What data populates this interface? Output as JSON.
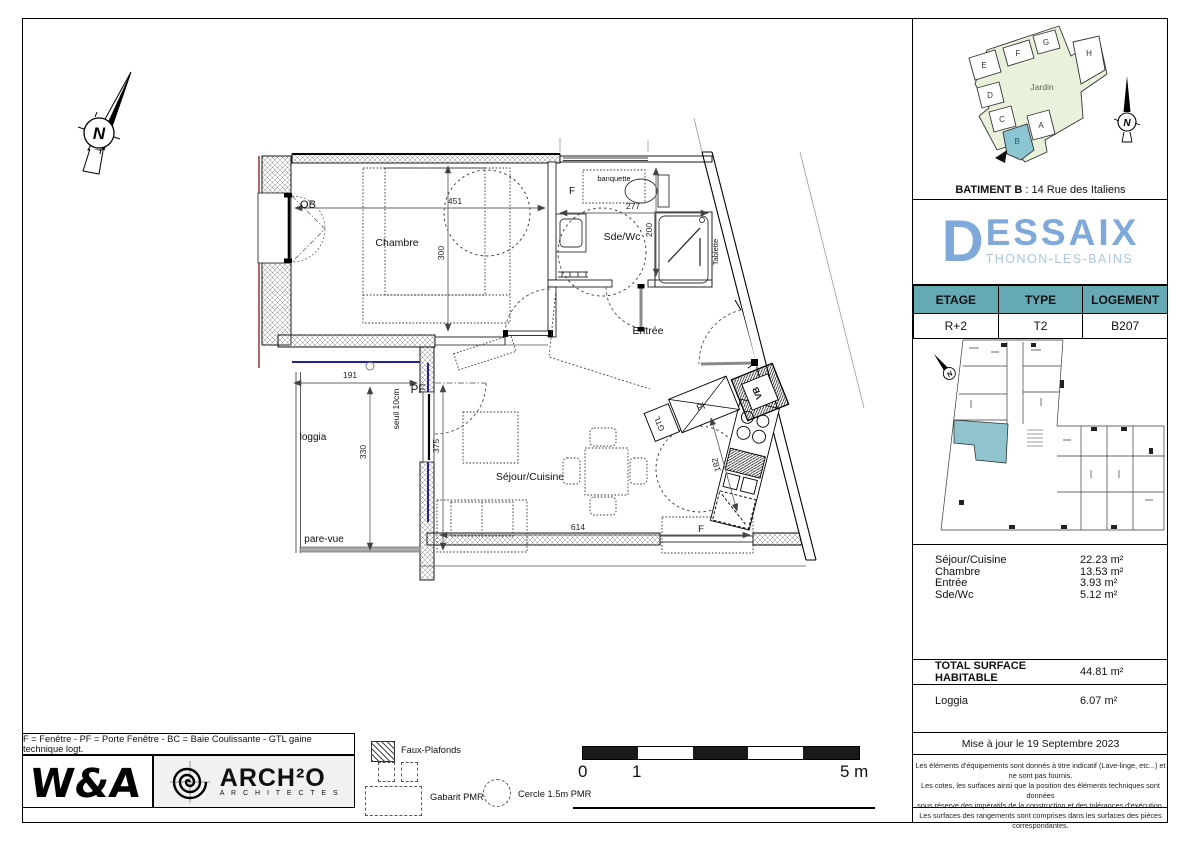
{
  "plan": {
    "north_letter": "N",
    "rooms": {
      "chambre": "Chambre",
      "sdwc": "Sde/Wc",
      "entree": "Entrée",
      "sejour": "Séjour/Cuisine",
      "loggia": "loggia"
    },
    "labels": {
      "ob": "OB",
      "pf": "PF",
      "f_sdb": "F",
      "f_sejour": "F",
      "banquette": "banquette",
      "tablette": "Tablette",
      "seuil": "seuil 10cm",
      "pare_vue": "pare-vue",
      "gtl": "GTL",
      "pl": "Pl",
      "vb": "VB"
    },
    "dims": {
      "chambre_w": "451",
      "chambre_h": "300",
      "sdb_w": "277",
      "sdb_h": "200",
      "loggia_w": "191",
      "loggia_h": "330",
      "sejour_h": "375",
      "sejour_w": "614",
      "cuisine": "182"
    }
  },
  "right_panel": {
    "site_plan": {
      "letters": [
        "A",
        "B",
        "C",
        "D",
        "E",
        "F",
        "G",
        "H"
      ],
      "garden": "Jardin",
      "north_letter": "N",
      "caption_bold": "BATIMENT B",
      "caption_sep": " :  ",
      "caption_text": "14 Rue des Italiens"
    },
    "brand": {
      "initial": "D",
      "rest": "ESSAIX",
      "city": "THONON-LES-BAINS"
    },
    "info": {
      "headers": [
        "ETAGE",
        "TYPE",
        "LOGEMENT"
      ],
      "values": [
        "R+2",
        "T2",
        "B207"
      ]
    },
    "key_plan": {
      "north_letter": "N"
    },
    "surfaces": {
      "rows": [
        {
          "label": "Séjour/Cuisine",
          "value": "22.23 m²"
        },
        {
          "label": "Chambre",
          "value": "13.53 m²"
        },
        {
          "label": "Entrée",
          "value": "3.93 m²"
        },
        {
          "label": "Sde/Wc",
          "value": "5.12 m²"
        }
      ],
      "total_label": "TOTAL SURFACE HABITABLE",
      "total_value": "44.81 m²",
      "loggia_label": "Loggia",
      "loggia_value": "6.07 m²"
    },
    "updated": "Mise à jour le 19 Septembre 2023",
    "disclaimer": [
      "Les éléments d'équipements sont donnés à titre indicatif (Lave-linge, etc...) et ne sont pas fournis.",
      "Les cotes, les surfaces ainsi que la position des éléments techniques sont données",
      "sous réserve des impératifs de la construction et des tolérances d'exécution.",
      "Les surfaces des rangements sont comprises dans les surfaces des pièces correspondantes."
    ]
  },
  "footer": {
    "abbreviations": "F = Fenêtre  -  PF = Porte Fenêtre  -  BC = Baie Coulissante  -  GTL gaine technique logt.",
    "wa_logo": "W&A",
    "archo_name": "ARCH²O",
    "archo_sub": "A R C H I T E C T E S",
    "legend": {
      "faux_plafonds": "Faux-Plafonds",
      "gabarit": "Gabarit PMR",
      "cercle": "Cercle 1.5m PMR"
    },
    "scale": {
      "zero": "0",
      "one": "1",
      "five": "5 m"
    }
  },
  "colors": {
    "accent_teal": "#64A9B4",
    "brand_blue": "#7FA9DB",
    "brand_light_blue": "#A9C6E5",
    "unit_highlight": "#8FC4CF",
    "garden_green": "#E9F1DB",
    "wall_red": "#8C3B2E",
    "glazing_blue": "#22229B"
  }
}
